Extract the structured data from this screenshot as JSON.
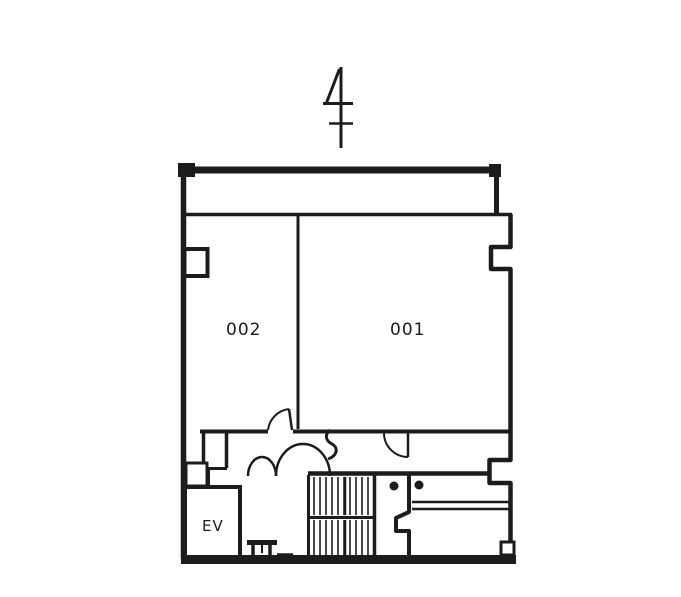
{
  "plan": {
    "north_indicator_icon": "north-arrow",
    "rooms": [
      {
        "label": "002"
      },
      {
        "label": "001"
      }
    ],
    "elevator_label": "EV",
    "colors": {
      "line": "#1c1c1c",
      "background": "#ffffff"
    }
  }
}
